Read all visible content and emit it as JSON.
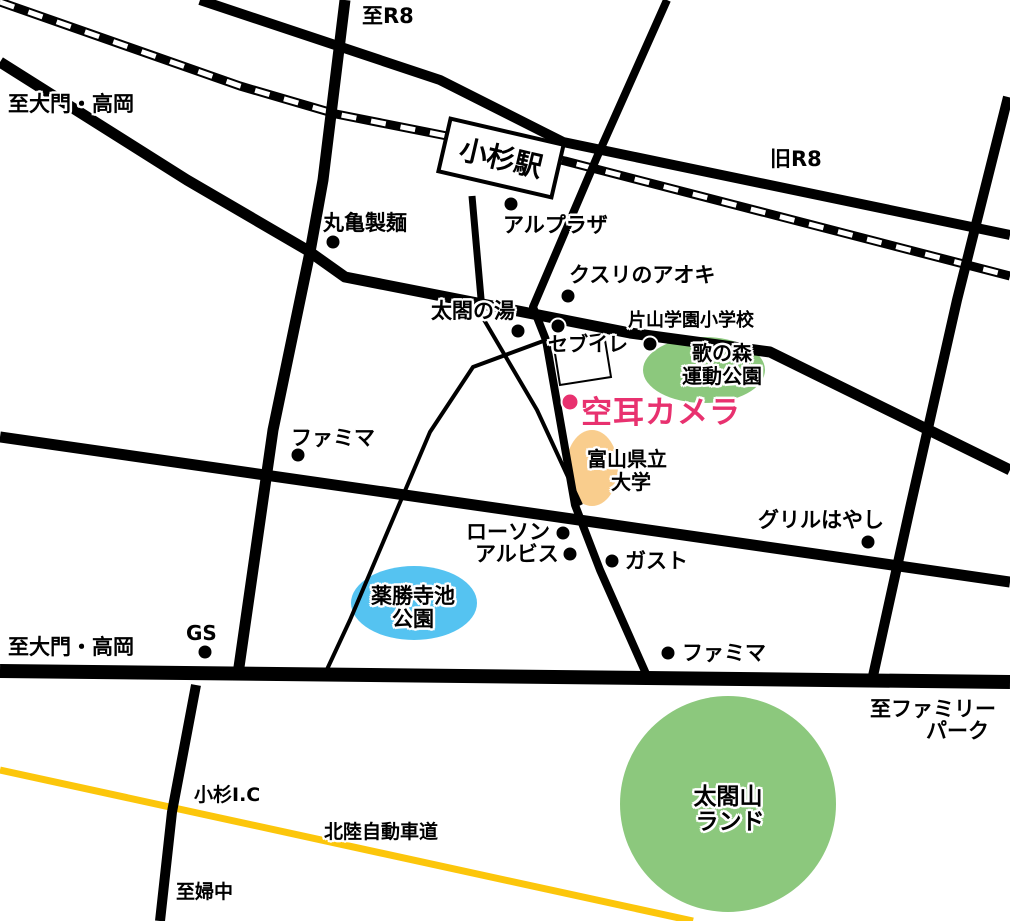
{
  "colors": {
    "background": "#ffffff",
    "road_black": "#000000",
    "railway_dash_white": "#ffffff",
    "highway_yellow": "#fcc60b",
    "destination_pink": "#e8316f",
    "park_green": "#8cc87d",
    "pond_blue": "#55c3f1",
    "university_orange": "#f9cd8d",
    "station_fill": "#ffffff"
  },
  "station": {
    "name": "小杉駅"
  },
  "destination": {
    "name": "空耳カメラ"
  },
  "road_labels": {
    "to_r8": "至R8",
    "to_daimon_takaoka_top": "至大門・高岡",
    "old_r8": "旧R8",
    "to_daimon_takaoka_bottom": "至大門・高岡",
    "to_family_park_line1": "至ファミリー",
    "to_family_park_line2": "パーク",
    "kosugi_ic": "小杉I.C",
    "hokuriku_expressway": "北陸自動車道",
    "to_fuchu": "至婦中"
  },
  "places": {
    "marugame_seimen": "丸亀製麺",
    "al_plaza": "アルプラザ",
    "kusuri_no_aoki": "クスリのアオキ",
    "taiko_no_yu": "太閤の湯",
    "katayama_gakuen_elementary": "片山学園小学校",
    "seven_eleven": "セブイレ",
    "utanomori_park_line1": "歌の森",
    "utanomori_park_line2": "運動公園",
    "famima_west": "ファミマ",
    "toyama_pref_univ_line1": "富山県立",
    "toyama_pref_univ_line2": "大学",
    "grill_hayashi": "グリルはやし",
    "lawson": "ローソン",
    "albis": "アルビス",
    "gusto": "ガスト",
    "yakushoji_pond_park_line1": "薬勝寺池",
    "yakushoji_pond_park_line2": "公園",
    "gas_station": "GS",
    "famima_south": "ファミマ",
    "taikoyama_land_line1": "太閤山",
    "taikoyama_land_line2": "ランド"
  }
}
